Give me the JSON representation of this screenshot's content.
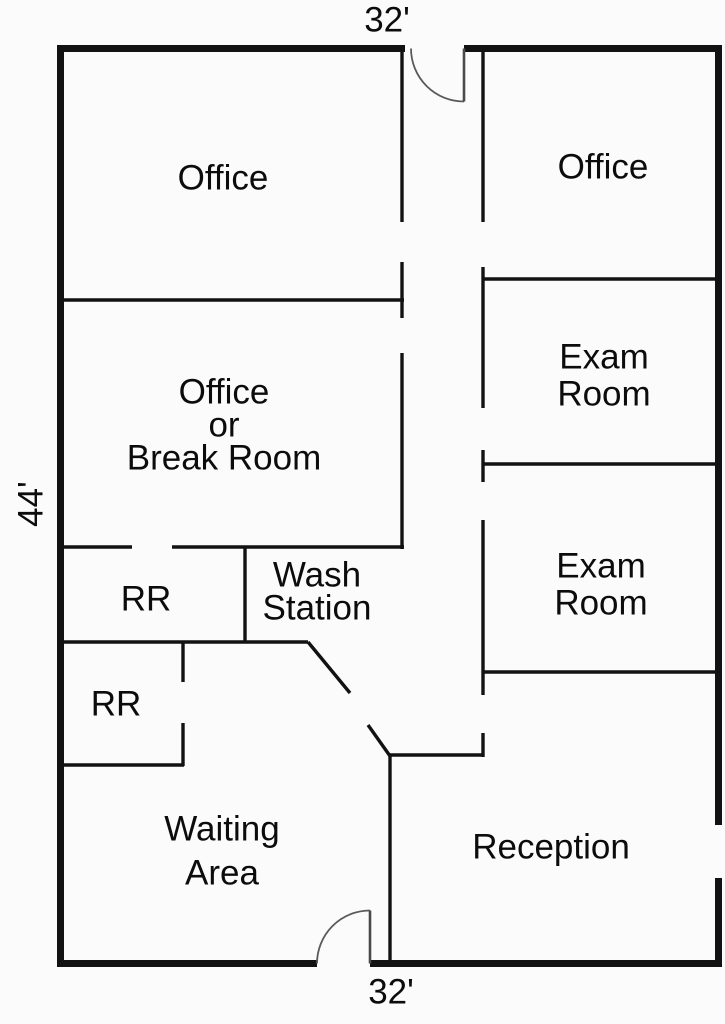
{
  "floorplan": {
    "canvas": {
      "width": 725,
      "height": 1024
    },
    "colors": {
      "background": "#fbfbfb",
      "wall": "#121212",
      "door_leaf": "#4a4a4a",
      "door_arc": "#5a5a5a",
      "text": "#0c0c0c"
    },
    "stroke_widths": {
      "outer_wall": 7,
      "interior_wall": 3.4,
      "door_leaf": 2.6,
      "door_arc": 1.8
    },
    "outer_walls": [
      [
        57,
        48.5,
        405,
        48.5
      ],
      [
        464,
        48.5,
        722,
        48.5
      ],
      [
        60.5,
        45,
        60.5,
        967
      ],
      [
        718.5,
        45,
        718.5,
        825
      ],
      [
        718.5,
        878,
        718.5,
        967
      ],
      [
        57,
        963.5,
        317,
        963.5
      ],
      [
        370,
        963.5,
        722,
        963.5
      ]
    ],
    "interior_walls": [
      [
        62,
        300,
        404,
        300
      ],
      [
        483,
        279,
        720,
        279
      ],
      [
        483,
        464,
        720,
        464
      ],
      [
        483,
        672,
        720,
        672
      ],
      [
        62,
        547,
        132,
        547
      ],
      [
        172,
        547,
        404,
        547
      ],
      [
        62,
        642,
        308,
        642
      ],
      [
        389,
        755,
        484,
        755
      ],
      [
        62,
        765,
        184,
        765
      ],
      [
        402,
        47,
        402,
        222
      ],
      [
        402,
        262,
        402,
        318
      ],
      [
        402,
        353,
        402,
        549
      ],
      [
        483,
        47,
        483,
        222
      ],
      [
        483,
        267,
        483,
        408
      ],
      [
        483,
        450,
        483,
        482
      ],
      [
        483,
        520,
        483,
        695
      ],
      [
        483,
        733,
        483,
        757
      ],
      [
        245,
        547,
        245,
        643
      ],
      [
        183,
        642,
        183,
        682
      ],
      [
        183,
        723,
        183,
        766
      ],
      [
        390,
        754,
        390,
        963
      ],
      [
        308,
        642,
        350,
        693
      ],
      [
        368,
        725,
        390,
        756
      ]
    ],
    "door_leaves": [
      [
        464,
        48.5,
        464,
        101.5
      ],
      [
        370,
        910.5,
        370,
        963.5
      ]
    ],
    "door_arcs": [
      "M 411 48.5 A 53 53 0 0 0 464 101.5",
      "M 317 963.5 A 53 53 0 0 1 370 910.5"
    ],
    "labels": [
      {
        "id": "dimension-top",
        "lines": [
          "32'"
        ],
        "x": 387,
        "y": 19,
        "font": 35,
        "line_height": 38,
        "rotate": 0
      },
      {
        "id": "dimension-bottom",
        "lines": [
          "32'"
        ],
        "x": 391,
        "y": 991,
        "font": 35,
        "line_height": 38,
        "rotate": 0
      },
      {
        "id": "dimension-left",
        "lines": [
          "44'"
        ],
        "x": 30,
        "y": 504,
        "font": 35,
        "line_height": 38,
        "rotate": -90
      },
      {
        "id": "room-office-northwest",
        "lines": [
          "Office"
        ],
        "x": 223,
        "y": 177,
        "font": 35,
        "line_height": 38,
        "rotate": 0
      },
      {
        "id": "room-office-northeast",
        "lines": [
          "Office"
        ],
        "x": 603,
        "y": 166,
        "font": 35,
        "line_height": 38,
        "rotate": 0
      },
      {
        "id": "room-exam-room-1",
        "lines": [
          "Exam",
          "Room"
        ],
        "x": 604,
        "y": 356,
        "font": 35,
        "line_height": 37,
        "rotate": 0
      },
      {
        "id": "room-exam-room-2",
        "lines": [
          "Exam",
          "Room"
        ],
        "x": 601,
        "y": 565,
        "font": 35,
        "line_height": 37,
        "rotate": 0
      },
      {
        "id": "room-office-break",
        "lines": [
          "Office",
          "or",
          "Break Room"
        ],
        "x": 224,
        "y": 391,
        "font": 35,
        "line_height": 33,
        "rotate": 0
      },
      {
        "id": "room-restroom-1",
        "lines": [
          "RR"
        ],
        "x": 146,
        "y": 598,
        "font": 35,
        "line_height": 38,
        "rotate": 0
      },
      {
        "id": "room-wash-station",
        "lines": [
          "Wash",
          "Station"
        ],
        "x": 317,
        "y": 574,
        "font": 35,
        "line_height": 33,
        "rotate": 0
      },
      {
        "id": "room-restroom-2",
        "lines": [
          "RR"
        ],
        "x": 116,
        "y": 703,
        "font": 35,
        "line_height": 38,
        "rotate": 0
      },
      {
        "id": "room-waiting-area",
        "lines": [
          "Waiting",
          "Area"
        ],
        "x": 222,
        "y": 828,
        "font": 35,
        "line_height": 44,
        "rotate": 0
      },
      {
        "id": "room-reception",
        "lines": [
          "Reception"
        ],
        "x": 551,
        "y": 846,
        "font": 35,
        "line_height": 38,
        "rotate": 0
      }
    ]
  }
}
